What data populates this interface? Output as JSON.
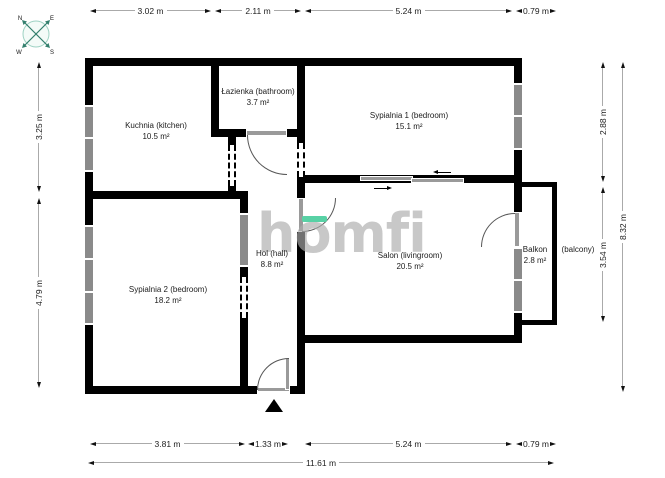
{
  "compass": {
    "n": "N",
    "e": "E",
    "w": "W",
    "s": "S"
  },
  "watermark": {
    "text": "homfi"
  },
  "rooms": {
    "kitchen": {
      "name": "Kuchnia (kitchen)",
      "area": "10.5 m²"
    },
    "bathroom": {
      "name": "Łazienka (bathroom)",
      "area": "3.7 m²"
    },
    "bedroom1": {
      "name": "Sypialnia 1 (bedroom)",
      "area": "15.1 m²"
    },
    "bedroom2": {
      "name": "Sypialnia 2 (bedroom)",
      "area": "18.2 m²"
    },
    "hall": {
      "name": "Hol (hall)",
      "area": "8.8 m²"
    },
    "livingroom": {
      "name": "Salon (livingroom)",
      "area": "20.5 m²"
    },
    "balcony": {
      "name": "Balkon",
      "area": "2.8 m²",
      "name_en": "(balcony)"
    }
  },
  "dimensions": {
    "top": [
      "3.02 m",
      "2.11 m",
      "5.24 m",
      "0.79 m"
    ],
    "bottom": [
      "3.81 m",
      "1.33 m",
      "5.24 m",
      "0.79 m"
    ],
    "bottom_total": "11.61 m",
    "left": [
      "3.25 m",
      "4.79 m"
    ],
    "right": [
      "2.88 m",
      "3.54 m",
      "8.32 m"
    ]
  },
  "colors": {
    "wall": "#000000",
    "window_gray": "#8a8a8a",
    "accent_green": "#58d1a5",
    "dim_line": "#aaaaaa"
  }
}
